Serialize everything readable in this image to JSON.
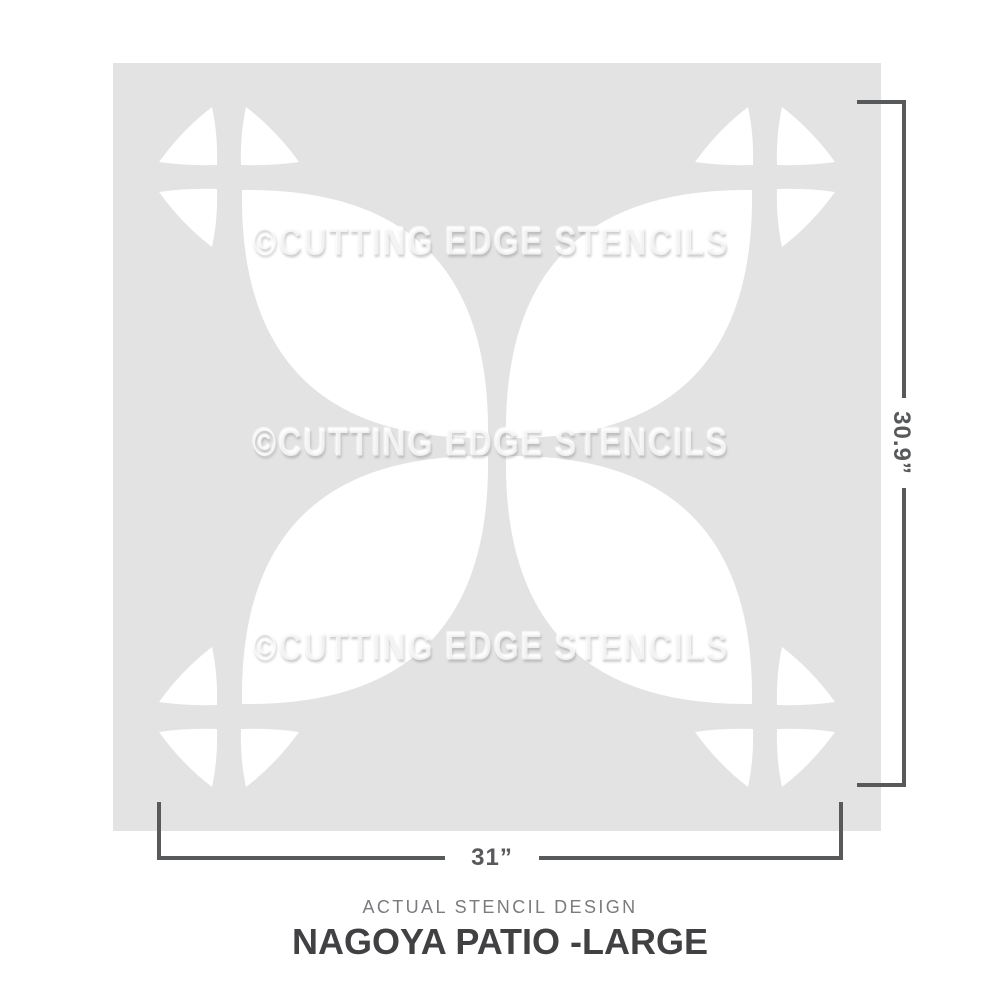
{
  "product": {
    "watermark": "©CUTTING EDGE STENCILS",
    "dimensions": {
      "width_label": "31”",
      "height_label": "30.9”"
    },
    "caption": "ACTUAL STENCIL DESIGN",
    "title": "NAGOYA PATIO -LARGE"
  },
  "colors": {
    "stencil_gray": "#e3e3e3",
    "cutout_white": "#ffffff",
    "dimension_line_gray": "#58595b",
    "caption_gray": "#7a7b7e",
    "title_dark": "#414143"
  }
}
